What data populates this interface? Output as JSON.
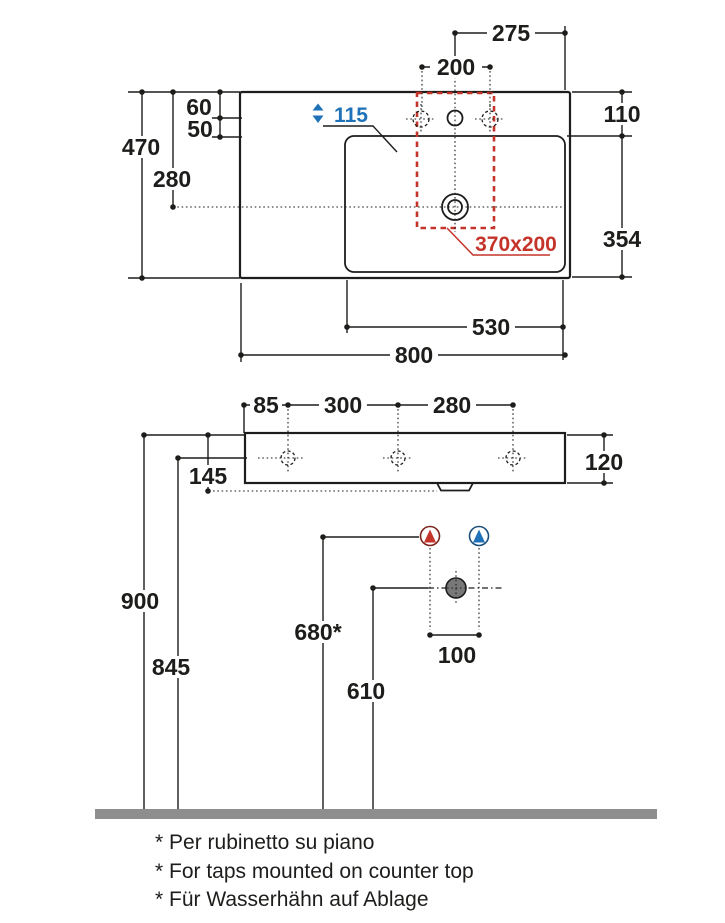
{
  "colors": {
    "ink": "#1d1d1b",
    "red": "#c5342b",
    "blue": "#1f72b8",
    "dark_red": "#7b241c",
    "dark_blue": "#1b4e79",
    "floor_gray": "#8e8e8e",
    "drain_gray": "#787878"
  },
  "top_view": {
    "overall_width": "800",
    "overall_depth": "470",
    "basin_width": "530",
    "drain_from_front": "280",
    "tap_to_right_edge": "275",
    "side_holes_spacing": "200",
    "front_edge_to_holes": "60",
    "holes_to_basin": "50",
    "right_edge_to_basin": "110",
    "basin_length": "354",
    "cutout_size": "370x200",
    "basin_depth": "115"
  },
  "front_view": {
    "edge_to_first_hole": "85",
    "hole_spacing_left": "300",
    "hole_spacing_right": "280",
    "body_height": "120",
    "top_to_fixing": "145"
  },
  "installation": {
    "rim_height": "900",
    "fixing_height": "845",
    "taps_height": "680*",
    "drain_height": "610",
    "supply_spacing": "100"
  },
  "footnotes": {
    "it": "* Per rubinetto su piano",
    "en": "* For taps mounted on counter top",
    "de": "* Für Wasserhähn auf Ablage"
  }
}
